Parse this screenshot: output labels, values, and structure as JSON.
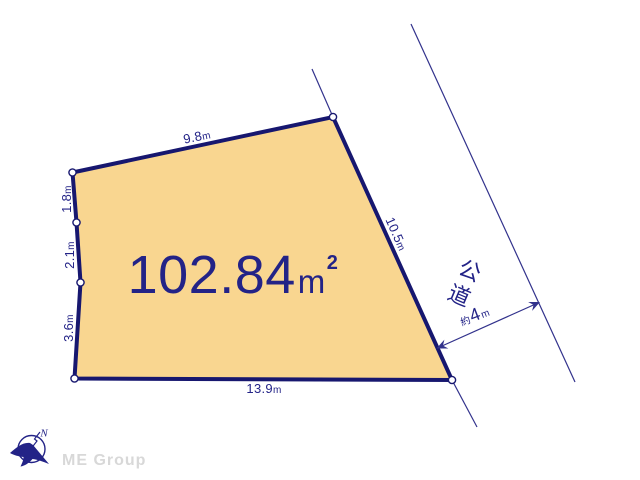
{
  "colors": {
    "navy": "#232387",
    "border": "#17176f",
    "line": "#32328c",
    "parcel": "#f9d690",
    "brand": "#d8d8d8",
    "bg": "#ffffff"
  },
  "parcel": {
    "area": {
      "value": "102.84",
      "unit": "m",
      "sup": "2"
    },
    "dimensions": {
      "top": {
        "value": "9.8",
        "unit": "m"
      },
      "left_upper": {
        "value": "1.8",
        "unit": "m"
      },
      "left_middle": {
        "value": "2.1",
        "unit": "m"
      },
      "left_lower": {
        "value": "3.6",
        "unit": "m"
      },
      "right": {
        "value": "10.5",
        "unit": "m"
      },
      "bottom": {
        "value": "13.9",
        "unit": "m"
      }
    }
  },
  "road": {
    "label": "公道",
    "width": {
      "prefix": "約",
      "value": "4",
      "unit": "m"
    }
  },
  "footer": {
    "brand": "ME Group",
    "compass_letter": "N"
  }
}
